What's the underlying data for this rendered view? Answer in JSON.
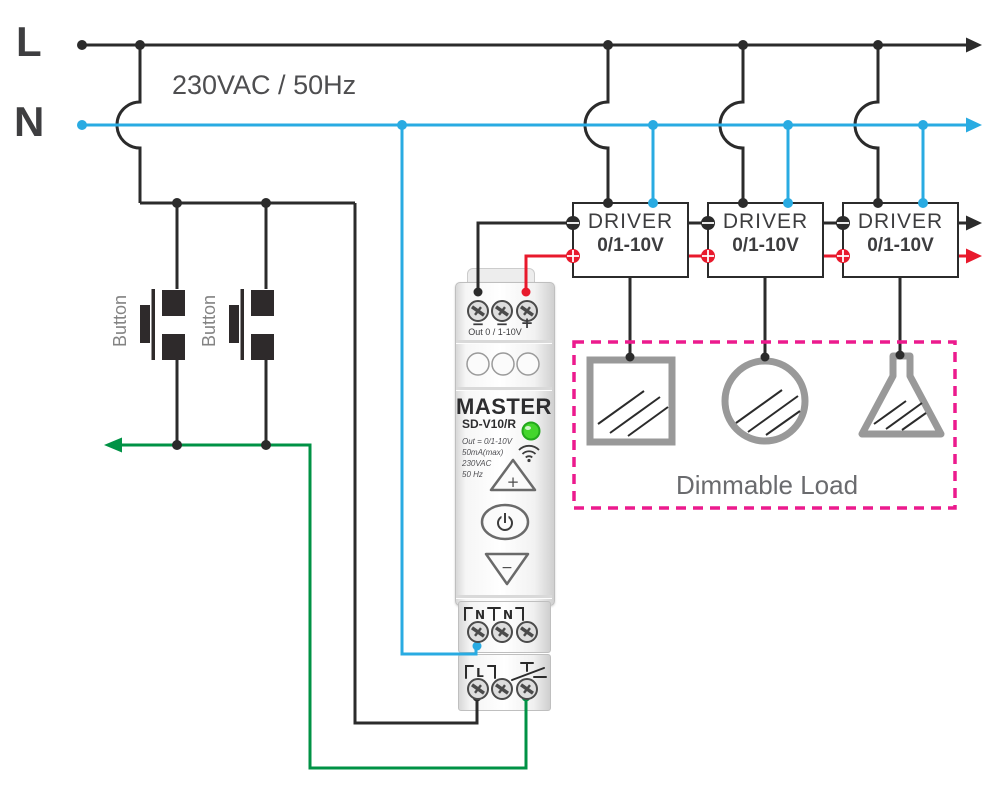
{
  "labels": {
    "line": "L",
    "neutral": "N",
    "supply": "230VAC / 50Hz",
    "button1": "Button",
    "button2": "Button",
    "dimmable_load": "Dimmable Load"
  },
  "drivers": [
    {
      "name": "DRIVER",
      "type": "0/1-10V"
    },
    {
      "name": "DRIVER",
      "type": "0/1-10V"
    },
    {
      "name": "DRIVER",
      "type": "0/1-10V"
    }
  ],
  "device": {
    "brand": "MASTER",
    "model": "SD-V10/R",
    "specs": {
      "out": "Out = 0/1-10V",
      "current": "50mA(max)",
      "voltage": "230VAC",
      "frequency": "50 Hz"
    },
    "output_terminals": {
      "minus1": "−",
      "minus2": "−",
      "plus": "+",
      "label": "Out 0 / 1-10V"
    },
    "controls": {
      "up": "+",
      "down": "−"
    },
    "input_terminals": {
      "n1": "N",
      "n2": "N",
      "l": "L"
    },
    "icons": [
      "led-indicator",
      "wifi-icon",
      "up-button",
      "power-button",
      "down-button",
      "push-switch-icon"
    ]
  },
  "colors": {
    "line_wire": "#2b2b2b",
    "neutral_wire": "#29abe2",
    "dim_signal_wire": "#e8192c",
    "switched_wire": "#009245",
    "load_outline": "#999999",
    "dimmable_zone_border": "#ec1a8d",
    "led": "#44d62c"
  }
}
